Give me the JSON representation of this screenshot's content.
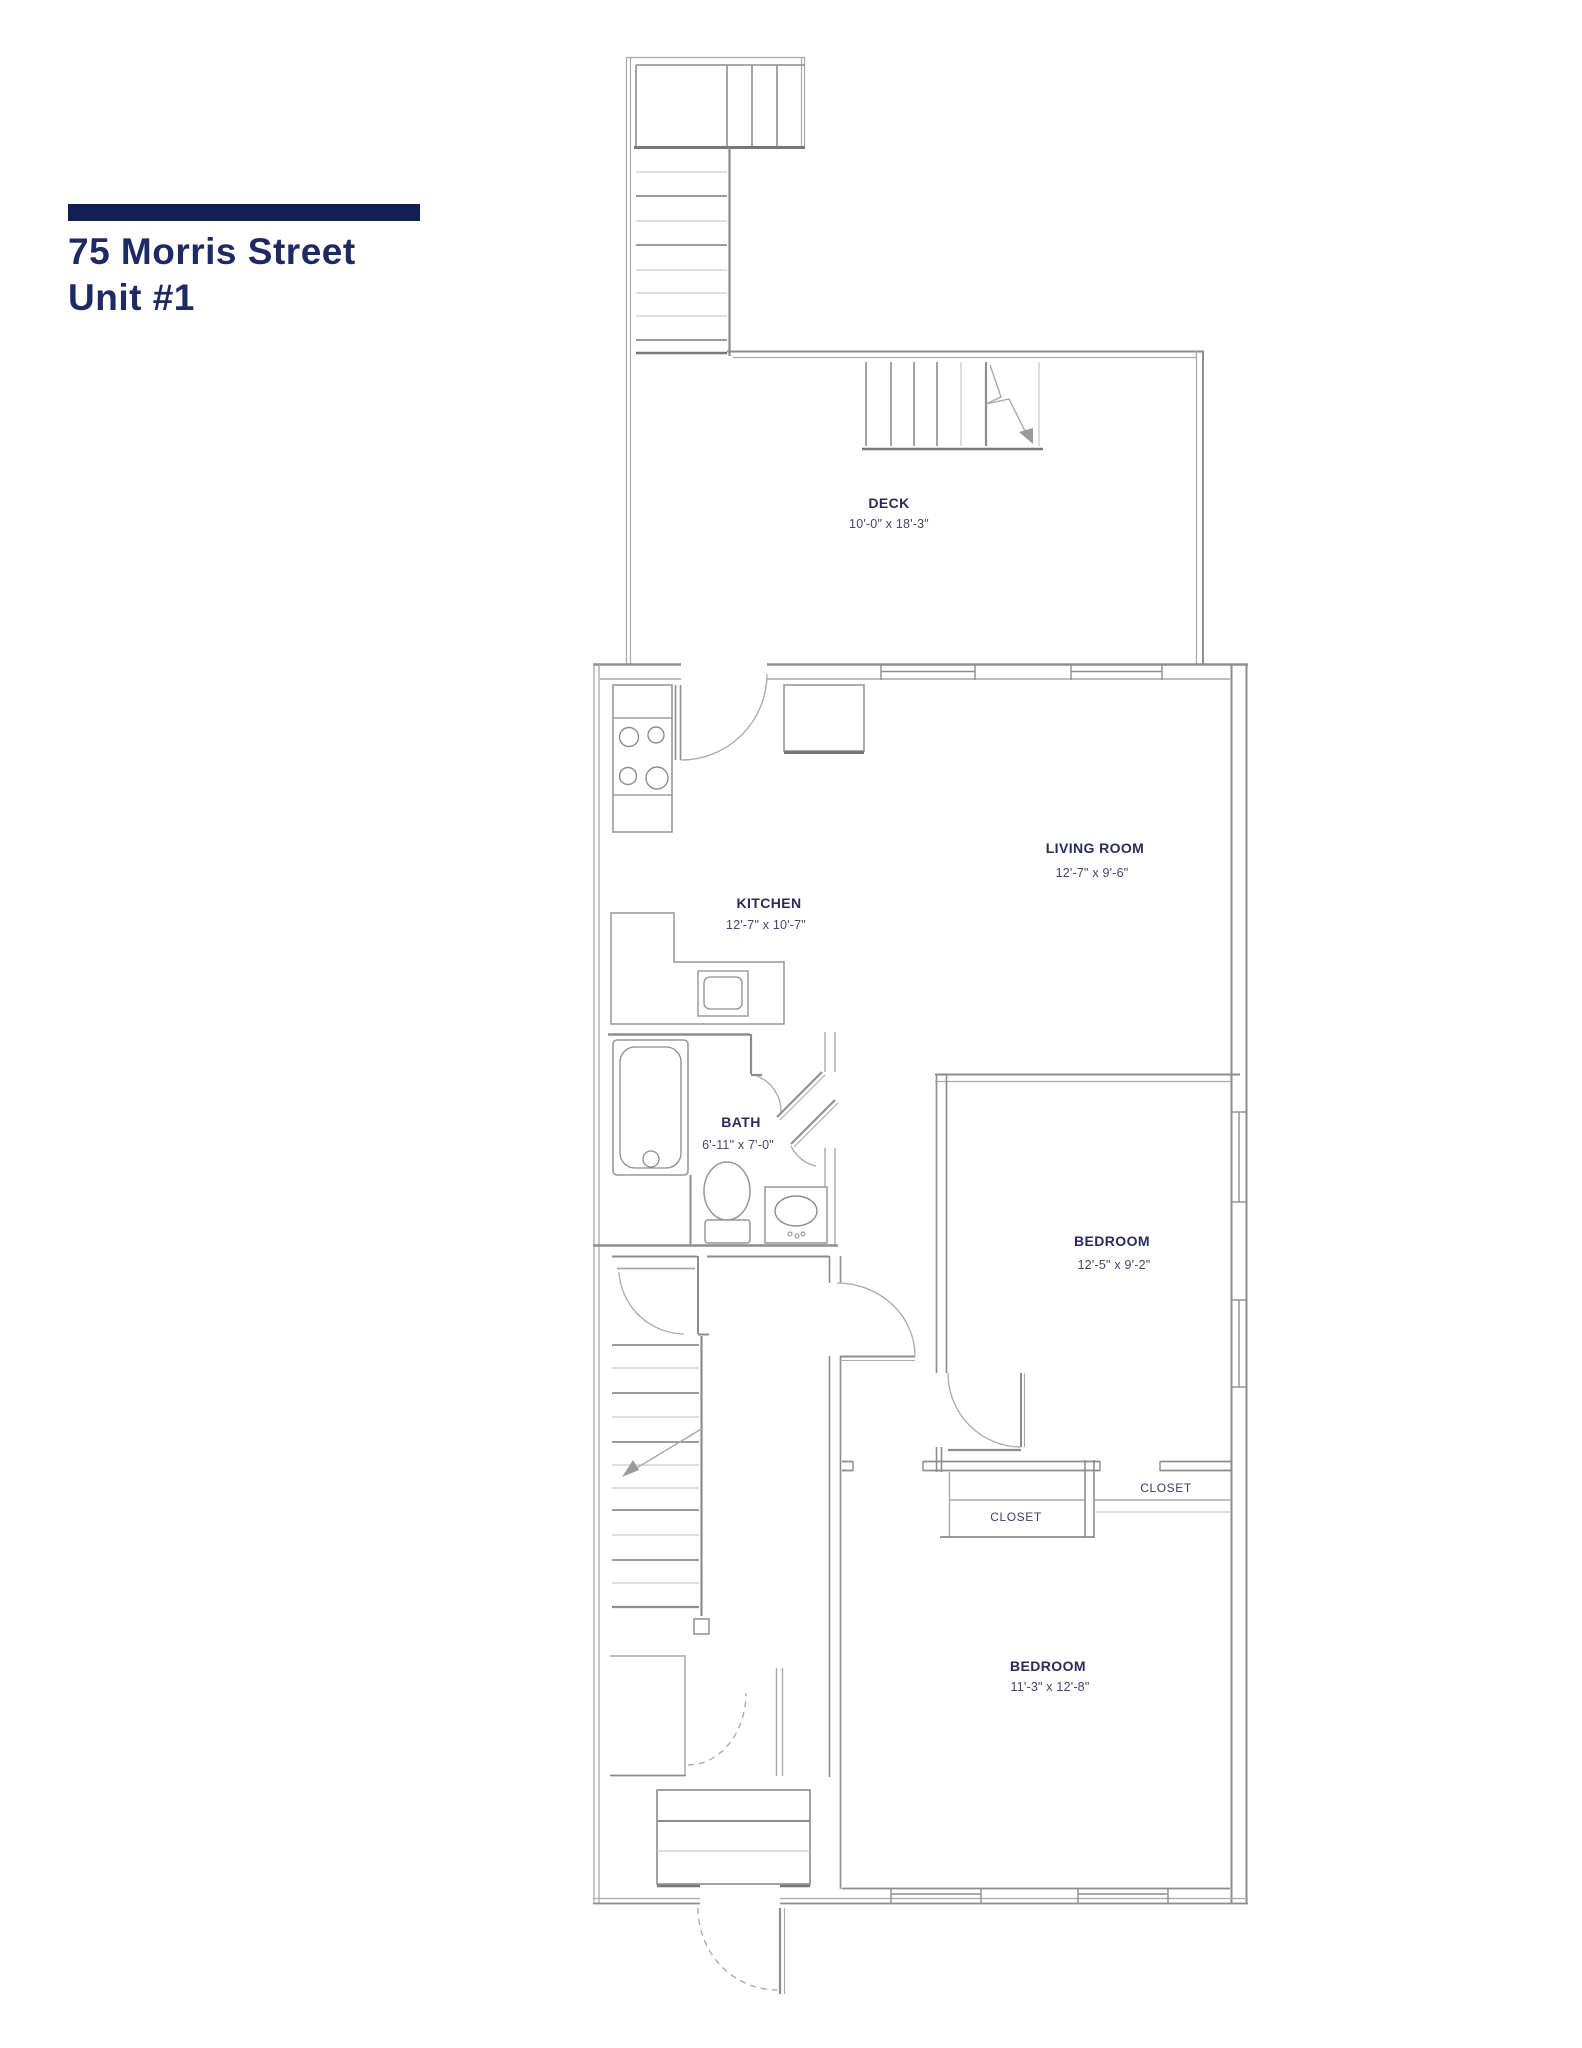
{
  "title": {
    "line1": "75 Morris Street",
    "line2": "Unit #1"
  },
  "rooms": {
    "deck": {
      "name": "DECK",
      "dims": "10'-0\" x 18'-3\""
    },
    "kitchen": {
      "name": "KITCHEN",
      "dims": "12'-7\" x 10'-7\""
    },
    "living_room": {
      "name": "LIVING ROOM",
      "dims": "12'-7\" x 9'-6\""
    },
    "bath": {
      "name": "BATH",
      "dims": "6'-11\" x 7'-0\""
    },
    "bedroom_1": {
      "name": "BEDROOM",
      "dims": "12'-5\" x 9'-2\""
    },
    "bedroom_2": {
      "name": "BEDROOM",
      "dims": "11'-3\" x 12'-8\""
    },
    "closet_left": {
      "name": "CLOSET"
    },
    "closet_right": {
      "name": "CLOSET"
    }
  },
  "colors": {
    "accent_navy_bar": "#101f54",
    "title_text": "#1d2a63",
    "room_label_text": "#2b2b5c",
    "wall_gray": "#8d8d8d"
  }
}
